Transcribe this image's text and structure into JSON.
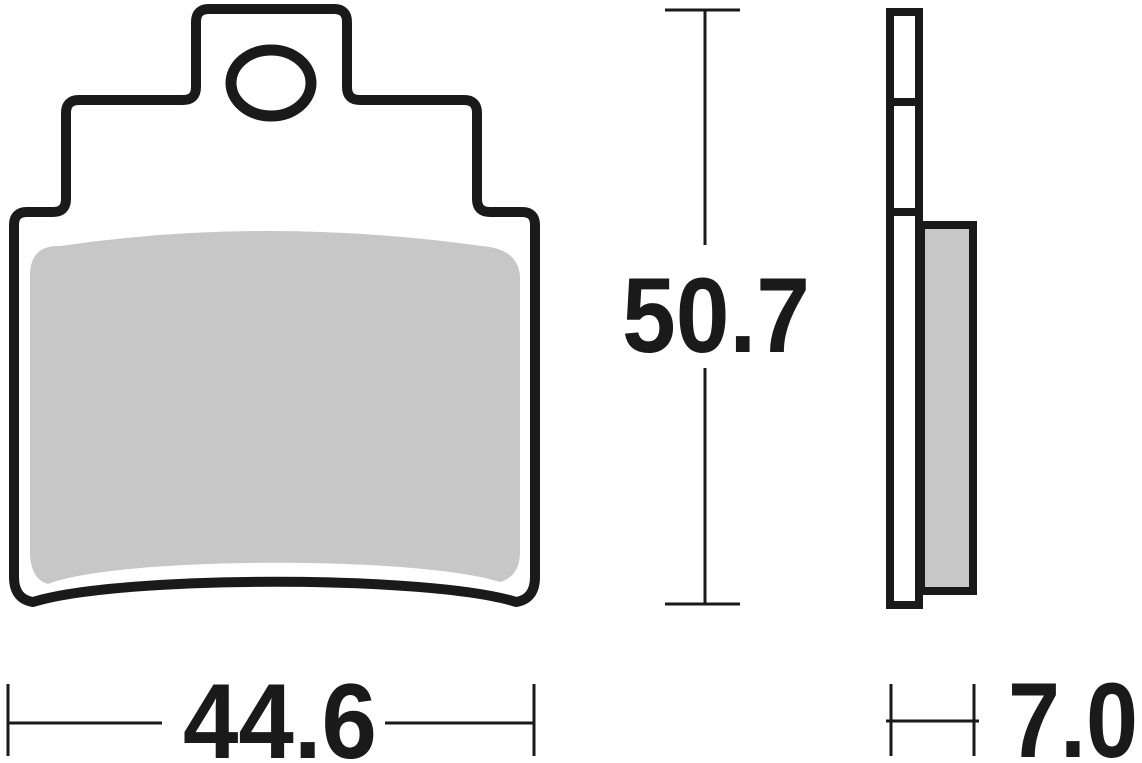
{
  "drawing": {
    "title": "Brake pad technical drawing",
    "views": {
      "front": {
        "name": "front view",
        "parts": [
          "backing-plate-outline",
          "mounting-hole",
          "friction-material"
        ]
      },
      "side": {
        "name": "side view",
        "parts": [
          "backing-plate-profile",
          "friction-material-profile"
        ]
      }
    },
    "dimensions": {
      "height": {
        "value": "50.7"
      },
      "width": {
        "value": "44.6"
      },
      "thickness": {
        "value": "7.0"
      }
    },
    "colors": {
      "outline": "#1a1a1a",
      "friction_material": "#c7c7c7",
      "plate_fill": "#ffffff",
      "background": "#ffffff"
    }
  }
}
